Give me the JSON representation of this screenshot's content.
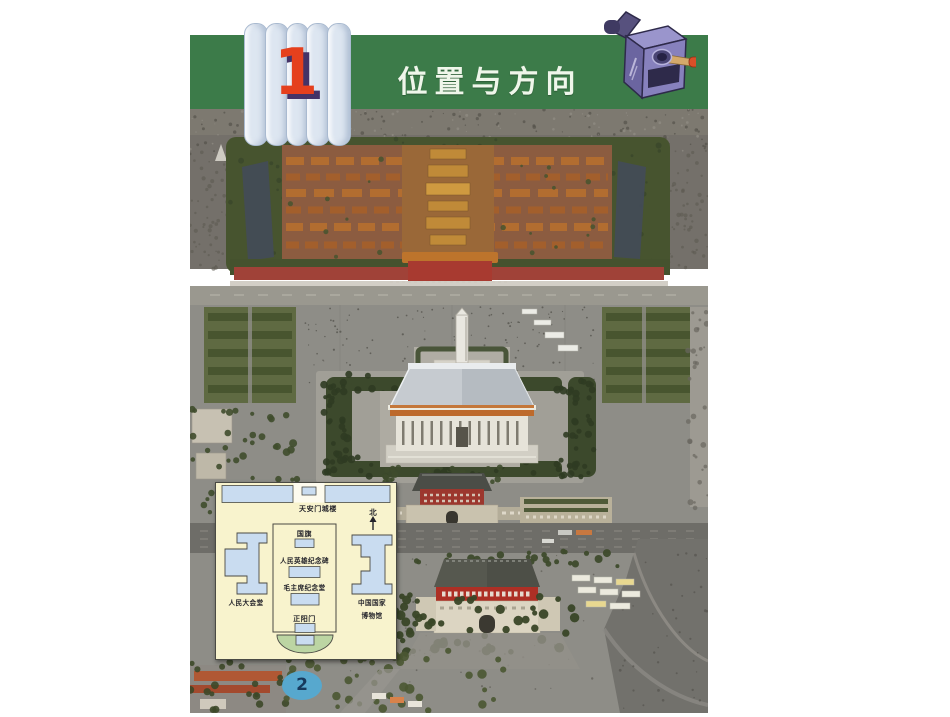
{
  "header": {
    "unit_number": "1",
    "title": "位置与方向"
  },
  "inset_map": {
    "labels": {
      "tiananmen_gate": "天安门城楼",
      "north": "北",
      "national_flag": "国旗",
      "heroes_monument": "人民英雄纪念碑",
      "mao_memorial_hall": "毛主席纪念堂",
      "zhengyangmen": "正阳门",
      "great_hall_of_people": "人民大会堂",
      "national_museum_line1": "中国国家",
      "national_museum_line2": "博物馆"
    }
  },
  "footer": {
    "page_number": "2"
  },
  "colors": {
    "band_green": "#3c7b49",
    "title_text": "#eff6ea",
    "unit_number_red": "#e5401d",
    "unit_shadow_purple": "#443367",
    "capsule_blue": "#dde6f1",
    "sharpener_purple": "#8781bd",
    "map_cream": "#f8f3cd",
    "map_building_blue": "#c9dcf0",
    "map_lawn_green": "#bcd5a3",
    "page_badge_blue": "#57a8ce"
  }
}
